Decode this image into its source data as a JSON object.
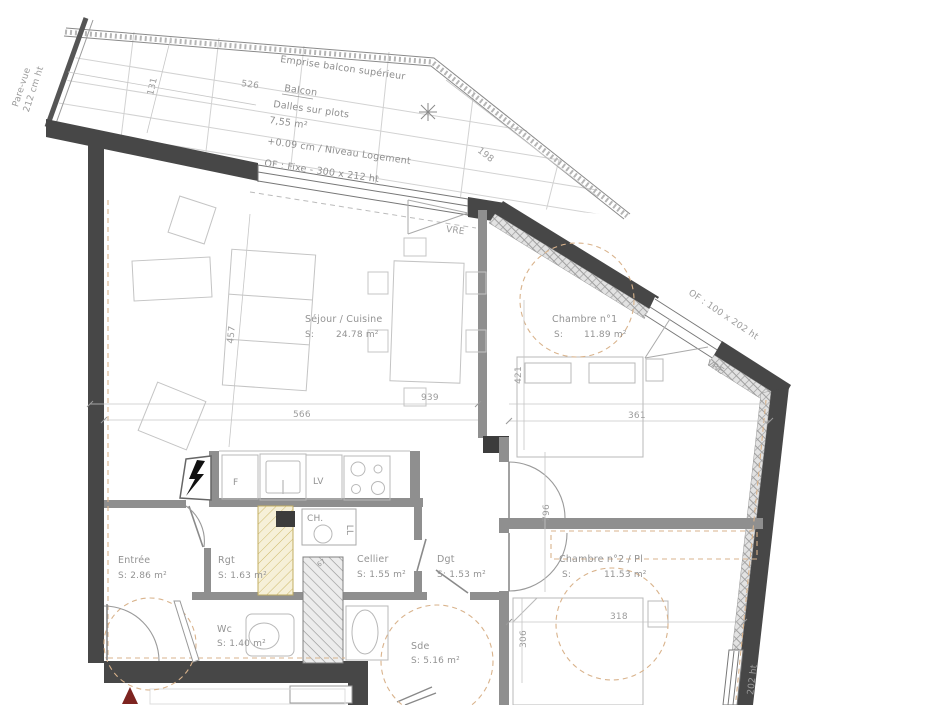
{
  "balcony": {
    "emprise": "Emprise balcon supérieur",
    "name": "Balcon",
    "slabs": "Dalles sur plots",
    "area": "7,55 m²",
    "level": "+0.09 cm / Niveau Logement",
    "window": "OF : Fixe - 300 x 212 ht",
    "pare_vue_line1": "Pare-vue",
    "pare_vue_line2": "212 cm ht"
  },
  "windows": {
    "vre_top": "VRE",
    "diag_label": "OF : 100 x 202 ht",
    "vre_diag": "VRE",
    "right_label": "202 ht"
  },
  "rooms": {
    "sejour": {
      "name": "Séjour / Cuisine",
      "s": "S:",
      "area": "24.78 m²"
    },
    "chambre1": {
      "name": "Chambre n°1",
      "s": "S:",
      "area": "11.89 m²"
    },
    "chambre2": {
      "name": "Chambre n°2 / Pl",
      "s": "S:",
      "area": "11.53 m²"
    },
    "entree": {
      "name": "Entrée",
      "area": "S: 2.86 m²"
    },
    "rgt": {
      "name": "Rgt",
      "area": "S: 1.63 m²"
    },
    "cellier": {
      "name": "Cellier",
      "area": "S: 1.55 m²"
    },
    "dgt": {
      "name": "Dgt",
      "area": "S: 1.53 m²"
    },
    "wc": {
      "name": "Wc",
      "area": "S: 1.40 m²"
    },
    "sde": {
      "name": "Sde",
      "area": "S: 5.16 m²"
    }
  },
  "fixtures": {
    "fridge": "F",
    "dishwasher": "LV",
    "water_heater": "CH.",
    "washer": "LL",
    "shaft": "67"
  },
  "dims": {
    "d526": "526",
    "d131": "131",
    "d198": "198",
    "d457": "457",
    "d939": "939",
    "d566": "566",
    "d421": "421",
    "d361": "361",
    "d796": "796",
    "d306": "306",
    "d318": "318"
  },
  "colors": {
    "wall": "#474747",
    "inner_wall": "#8f8f8f",
    "entry_marker": "#7d2420",
    "dashed_accent": "#d9b38c"
  }
}
